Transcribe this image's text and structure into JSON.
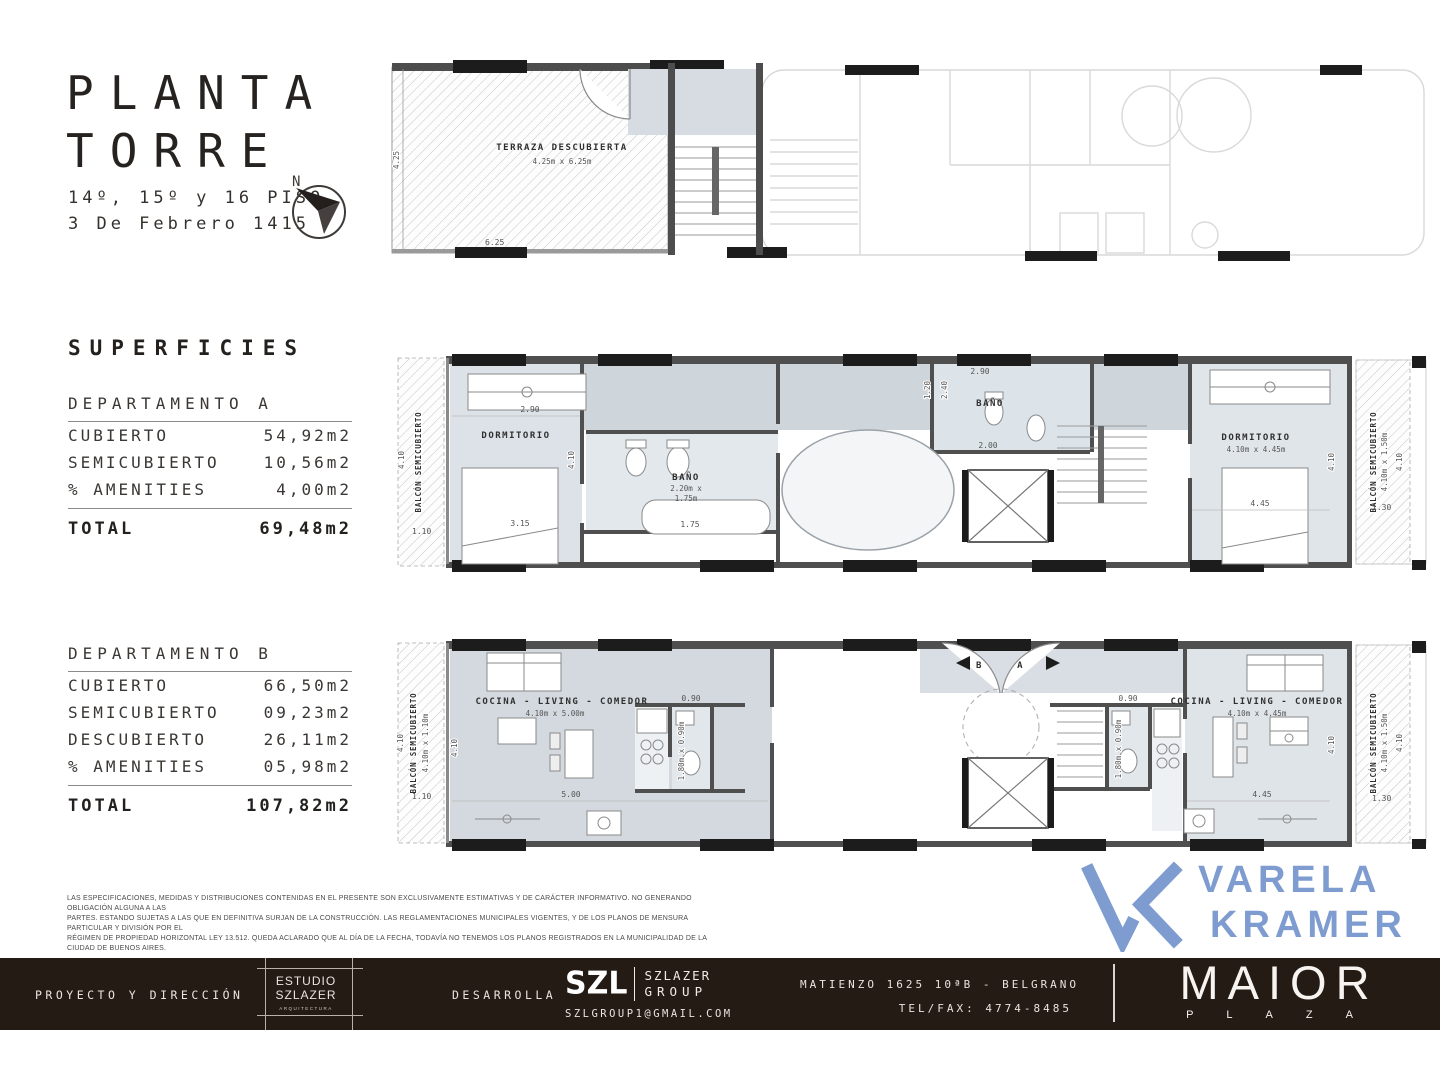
{
  "header": {
    "title_line1": "PLANTA",
    "title_line2": "TORRE",
    "subtitle_line1": "14º, 15º y 16 PISO",
    "subtitle_line2": "3 De Febrero 1415",
    "compass_label": "N"
  },
  "superficies": {
    "heading": "SUPERFICIES",
    "dept_a": {
      "title": "DEPARTAMENTO A",
      "rows": [
        {
          "label": "CUBIERTO",
          "value": "54,92m2"
        },
        {
          "label": "SEMICUBIERTO",
          "value": "10,56m2"
        },
        {
          "label": "% AMENITIES",
          "value": "4,00m2"
        }
      ],
      "total_label": "TOTAL",
      "total_value": "69,48m2"
    },
    "dept_b": {
      "title": "DEPARTAMENTO B",
      "rows": [
        {
          "label": "CUBIERTO",
          "value": "66,50m2"
        },
        {
          "label": "SEMICUBIERTO",
          "value": "09,23m2"
        },
        {
          "label": "DESCUBIERTO",
          "value": "26,11m2"
        },
        {
          "label": "% AMENITIES",
          "value": "05,98m2"
        }
      ],
      "total_label": "TOTAL",
      "total_value": "107,82m2"
    }
  },
  "plans": {
    "tower": {
      "terrace_label": "TERRAZA DESCUBIERTA",
      "terrace_dims": "4.25m x 6.25m",
      "dim_425": "4.25",
      "dim_625": "6.25"
    },
    "dept_a": {
      "balcony_label": "BALCÓN SEMICUBIERTO",
      "balcony_r_dims": "4.10m x 1.50m",
      "bedroom_label": "DORMITORIO",
      "bedroom_r_dims": "4.10m x 4.45m",
      "bath_label": "BAÑO",
      "bath_dims_a": "2.20m x",
      "bath_dims_b": "1.75m",
      "dim_410": "4.10",
      "dim_110": "1.10",
      "dim_130": "1.30",
      "dim_290": "2.90",
      "dim_315": "3.15",
      "dim_175": "1.75",
      "dim_200": "2.00",
      "dim_120": "1.20",
      "dim_240": "2.40",
      "dim_445": "4.45"
    },
    "dept_b": {
      "balcony_label": "BALCÓN SEMICUBIERTO",
      "balcony_l_dims": "4.10m x 1.10m",
      "balcony_r_dims": "4.10m x 1.50m",
      "living_label": "COCINA - LIVING - COMEDOR",
      "living_l_dims": "4.10m x 5.00m",
      "living_r_dims": "4.10m x 4.45m",
      "bath_dims": "1.80m x 0.90m",
      "bath_dim_090": "0.90",
      "marker_b": "B",
      "marker_a": "A",
      "dim_410": "4.10",
      "dim_110": "1.10",
      "dim_130": "1.30",
      "dim_500": "5.00",
      "dim_445": "4.45"
    }
  },
  "disclaimer": {
    "line1": "LAS ESPECIFICACIONES, MEDIDAS Y DISTRIBUCIONES CONTENIDAS EN EL PRESENTE SON EXCLUSIVAMENTE ESTIMATIVAS Y DE CARÁCTER INFORMATIVO. NO GENERANDO OBLIGACIÓN ALGUNA A LAS",
    "line2": "PARTES. ESTANDO SUJETAS A LAS QUE EN DEFINITIVA SURJAN DE LA CONSTRUCCIÓN. LAS REGLAMENTACIONES MUNICIPALES VIGENTES, Y DE LOS PLANOS DE MENSURA PARTICULAR Y DIVISIÓN POR EL",
    "line3": "RÉGIMEN DE PROPIEDAD HORIZONTAL LEY 13.512. QUEDA ACLARADO QUE AL DÍA DE LA FECHA, TODAVÍA NO TENEMOS LOS PLANOS REGISTRADOS EN LA MUNICIPALIDAD DE LA CIUDAD DE BUENOS AIRES.",
    "color": "#4a4a4a"
  },
  "varela": {
    "name_line1": "VARELA",
    "name_line2": "KRAMER",
    "brand_color": "#7e9cd0"
  },
  "footer": {
    "proyecto_label": "PROYECTO Y DIRECCIÓN",
    "estudio_line1": "ESTUDIO",
    "estudio_line2": "SZLAZER",
    "estudio_sub": "ARQUITECTURA",
    "desarrolla_label": "DESARROLLA",
    "szl_mark": "SZL",
    "szl_name_line1": "SZLAZER",
    "szl_name_line2": "GROUP",
    "szl_email": "SZLGROUP1@GMAIL.COM",
    "address": "MATIENZO 1625 10ªB - BELGRANO",
    "phone": "TEL/FAX: 4774-8485",
    "maior": "MAIOR",
    "plaza": "PLAZA",
    "background": "#241b15"
  },
  "colors": {
    "accent_blue": "#7e9cd0",
    "wall_dark": "#4d4d4d",
    "wall_black": "#1c1c1c",
    "room_fill": "#dce2e7",
    "hall_fill": "#cfd6db",
    "footer_bg": "#241b15"
  }
}
